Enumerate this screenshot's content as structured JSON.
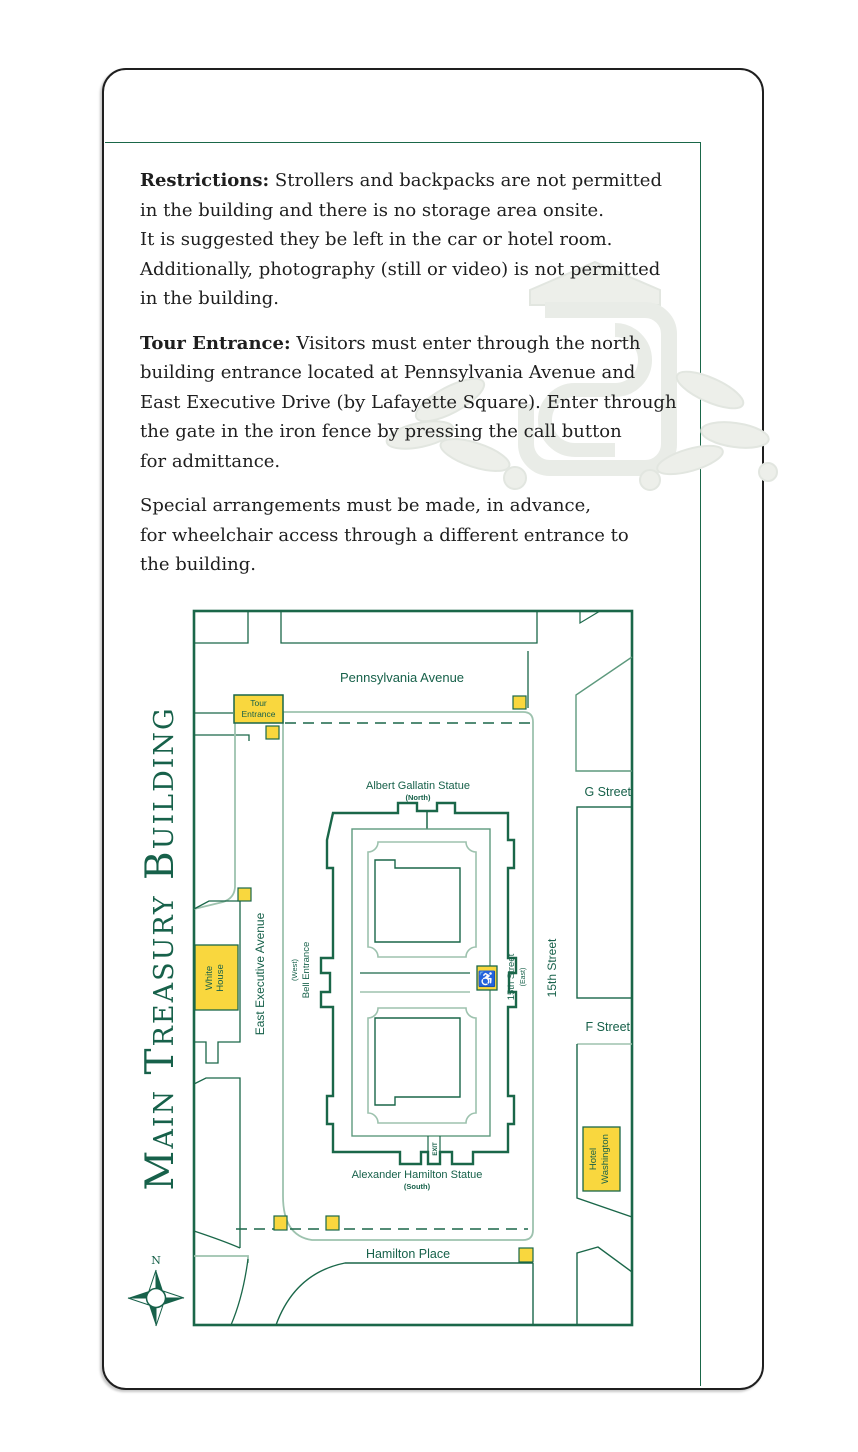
{
  "colors": {
    "dark_green": "#1a6749",
    "light_green": "#9dc2ae",
    "medium_green": "#5d997d",
    "highlight_yellow": "#f9d73e",
    "body_text": "#1e1e1e",
    "card_border": "#1f1f1f",
    "watermark_gray": "#edefea"
  },
  "intro": {
    "paragraphs": [
      {
        "lead": "Restrictions:",
        "text": " Strollers and backpacks are not permitted\nin the building and there is no storage area onsite.\nIt is suggested they be left in the car or hotel room.\nAdditionally, photography (still or video) is not permitted\nin the building."
      },
      {
        "lead": "Tour Entrance:",
        "text": " Visitors must enter through the north\nbuilding entrance located at Pennsylvania Avenue and\nEast Executive Drive (by Lafayette Square). Enter through\nthe gate in the iron fence by pressing the call button\nfor admittance."
      },
      {
        "lead": "",
        "text": "Special arrangements must be made, in advance,\nfor wheelchair access through a different entrance to\nthe building."
      }
    ]
  },
  "map": {
    "title": "Main Treasury Building",
    "compass_label": "N",
    "wheelchair_icon": "♿",
    "labels": {
      "pennsylvania_avenue": "Pennsylvania Avenue",
      "tour_entrance_line1": "Tour",
      "tour_entrance_line2": "Entrance",
      "gallatin_statue": "Albert Gallatin Statue",
      "gallatin_sub": "(North)",
      "g_street": "G Street",
      "east_executive_avenue": "East Executive Avenue",
      "bell_entrance_sub": "(West)",
      "bell_entrance": "Bell Entrance",
      "street15_east": "15th Street",
      "street15_east_sub": "(East)",
      "street15": "15th Street",
      "f_street": "F Street",
      "white_house_line1": "White",
      "white_house_line2": "House",
      "hotel_line1": "Hotel",
      "hotel_line2": "Washington",
      "exit": "EXIT",
      "hamilton_statue": "Alexander Hamilton Statue",
      "hamilton_sub": "(South)",
      "hamilton_place": "Hamilton Place"
    }
  }
}
